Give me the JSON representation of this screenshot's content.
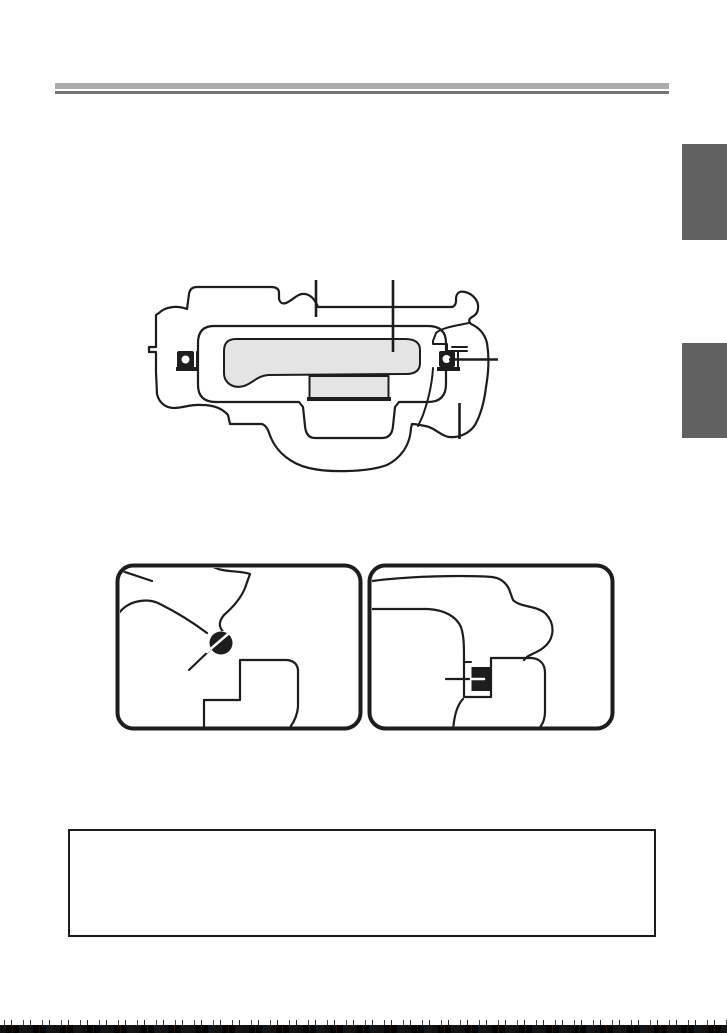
{
  "page": {
    "kind": "scanned-manual-page",
    "visible_text": "",
    "width_px": 727,
    "height_px": 1033
  },
  "colors": {
    "paper": "#ffffff",
    "ink": "#1d1d1d",
    "lcd": "#e4e4e4",
    "rule_light": "#acacac",
    "rule_dark": "#757575",
    "tab": "#616161"
  },
  "header": {
    "double_rule": {
      "x": 55,
      "y": 83,
      "width": 614
    }
  },
  "side_tabs": [
    {
      "name": "chapter-tab-1",
      "top": 144,
      "height": 96
    },
    {
      "name": "chapter-tab-2",
      "top": 343,
      "height": 95
    }
  ],
  "figures": [
    {
      "name": "camera-back-diagram",
      "description": "Inverted camera back outline with LCD monitor, viewfinder eyepiece, left and right strap eyelets",
      "callouts": [
        {
          "name": "callout-top-left-vertical"
        },
        {
          "name": "callout-top-center-vertical-to-lcd"
        },
        {
          "name": "callout-right-horizontal-to-eyelet"
        },
        {
          "name": "callout-bottom-right-vertical"
        }
      ]
    },
    {
      "name": "detail-box-left",
      "description": "Close-up of strap eyelet with pin through angled mount"
    },
    {
      "name": "detail-box-right",
      "description": "Close-up of strap eyelet slot with pointer line"
    }
  ],
  "note_box": {
    "text": "",
    "x": 68,
    "y": 829,
    "width": 590,
    "height": 110
  },
  "scan_noise_strip": {
    "position": "bottom-edge"
  }
}
